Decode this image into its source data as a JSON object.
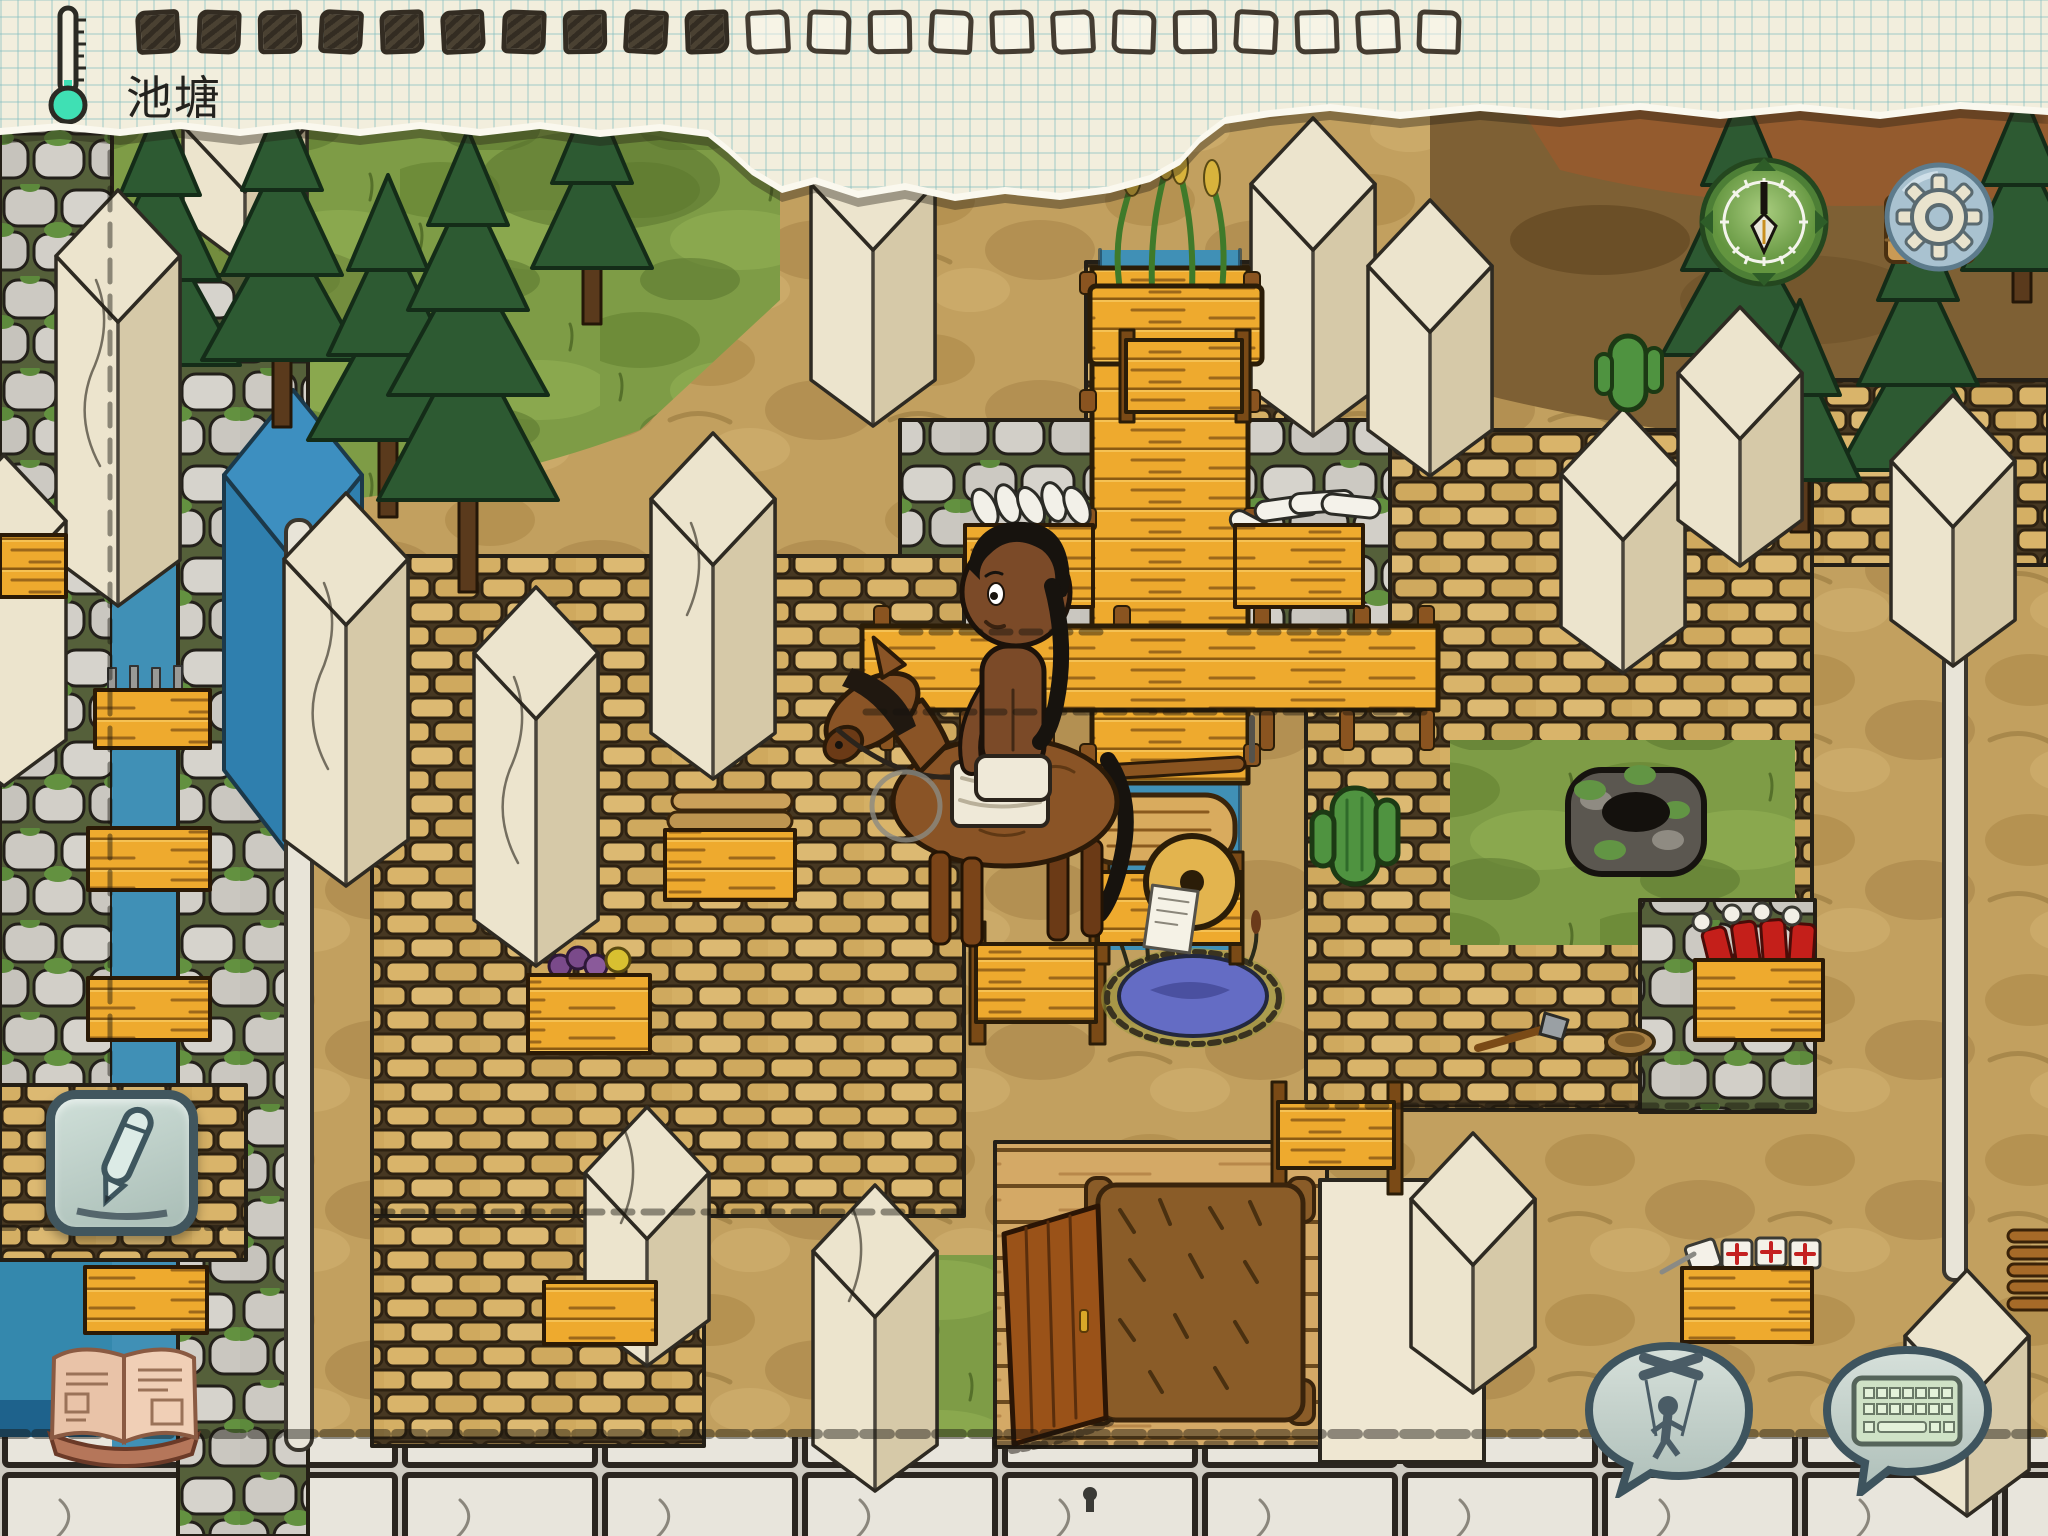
{
  "top_bar": {
    "location_label": "池塘",
    "food_pips": {
      "filled": 10,
      "empty": 12,
      "total": 22
    },
    "thermometer": {
      "icon": "thermometer-icon",
      "fluid_color": "#3fe0b4",
      "level": "low"
    },
    "paper_color": "#f2eedd",
    "grid_color": "#b9d3d4",
    "ink_color": "#413a2e"
  },
  "hud": {
    "temperature_gauge_button": {
      "icon": "gauge-needle-icon",
      "color": "#6fa14e"
    },
    "settings_button": {
      "icon": "gear-icon",
      "color": "#a9c2d0"
    },
    "write_button": {
      "icon": "pencil-icon",
      "color": "#c0d2ca"
    },
    "recipe_book_button": {
      "icon": "open-book-icon",
      "color": "#daa68c"
    },
    "puppet_speech_button": {
      "icon": "marionette-icon",
      "color": "#c3d3cd"
    },
    "keyboard_chat_button": {
      "icon": "keyboard-icon",
      "color": "#c3d3cd"
    }
  },
  "scene": {
    "style": "hand-drawn ink and crayon survival game world",
    "terrain": [
      "grass",
      "dirt",
      "forest humus",
      "stone slab road",
      "water channels"
    ],
    "objects": [
      "pine-tree x9",
      "white-stone-pillar x15",
      "cobblestone-wall",
      "adobe-brick-wall",
      "plaster-wall",
      "plank-wall",
      "wooden-bridge-over-canal",
      "yellow-plank-fence",
      "wheat-planter",
      "wool-crate x2",
      "storage-crate x6",
      "log-crate",
      "berry-crate",
      "red-tool-crate",
      "medical-kit-crate",
      "horse-with-rider",
      "wooden-cart",
      "pond",
      "cactus x2",
      "stone-well",
      "bear-hide",
      "wooden-door",
      "white-post x2",
      "axe",
      "bowl",
      "basket",
      "rope-coil"
    ]
  }
}
